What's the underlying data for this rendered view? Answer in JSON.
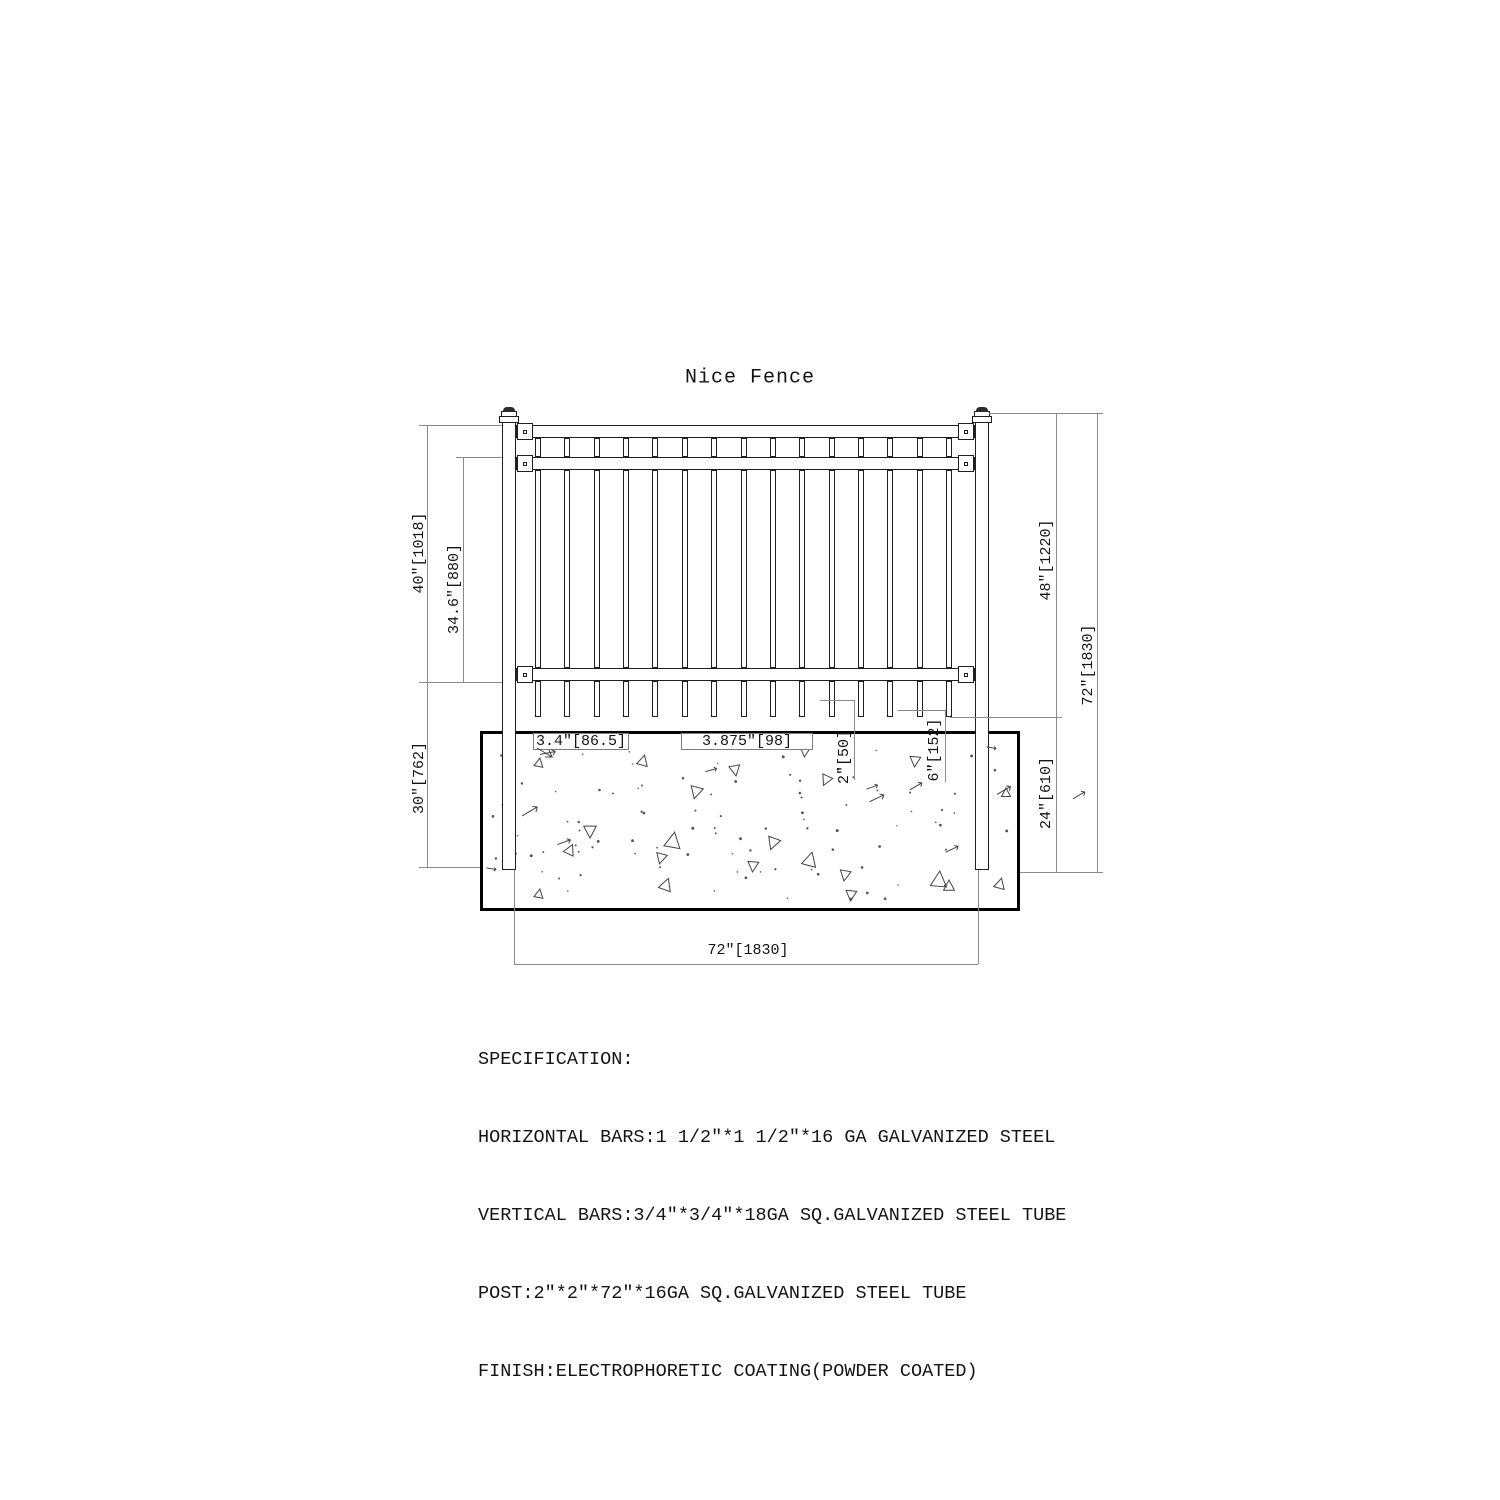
{
  "page": {
    "title": "Nice Fence"
  },
  "drawing": {
    "dim_labels": {
      "height_40": "40″[1018]",
      "height_34_6": "34.6″[880]",
      "depth_30": "30″[762]",
      "height_48": "48″[1220]",
      "height_72": "72″[1830]",
      "depth_24": "24″[610]",
      "width_72": "72″[1830]",
      "bar_gap": "3.4″[86.5]",
      "bar_pitch": "3.875″[98]",
      "edge_gap": "2″[50]",
      "picket_drop": "6″[152]"
    }
  },
  "specification": {
    "heading": "SPECIFICATION:",
    "lines": [
      "HORIZONTAL BARS:1 1/2″*1 1/2″*16 GA GALVANIZED STEEL",
      "VERTICAL BARS:3/4″*3/4″*18GA SQ.GALVANIZED STEEL TUBE",
      "POST:2″*2″*72″*16GA SQ.GALVANIZED STEEL TUBE",
      "FINISH:ELECTROPHORETIC COATING(POWDER COATED)"
    ]
  },
  "colors": {
    "line": "#1f1f1f",
    "dim": "#8a8a8a",
    "text": "#141414"
  }
}
